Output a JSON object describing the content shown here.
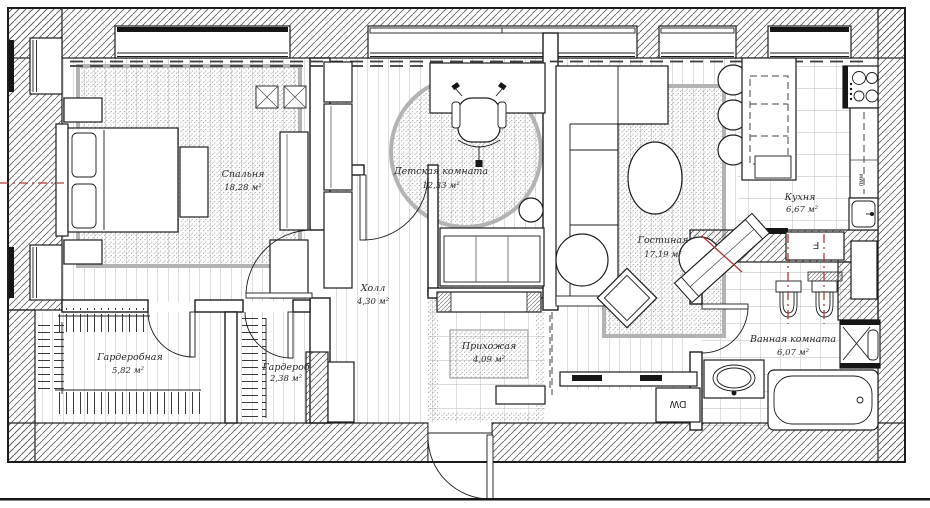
{
  "drawing": {
    "kind": "apartment-floor-plan",
    "rooms": [
      {
        "id": "bedroom",
        "name": "Спальня",
        "area": "18,28 м²"
      },
      {
        "id": "kids-room",
        "name": "Детская комната",
        "area": "12,33 м²"
      },
      {
        "id": "living-room",
        "name": "Гостиная",
        "area": "17,19 м²"
      },
      {
        "id": "kitchen",
        "name": "Кухня",
        "area": "6,67 м²"
      },
      {
        "id": "hall",
        "name": "Холл",
        "area": "4,30 м²"
      },
      {
        "id": "entry",
        "name": "Прихожая",
        "area": "4,09 м²"
      },
      {
        "id": "walk-in-closet",
        "name": "Гардеробная",
        "area": "5,82 м²"
      },
      {
        "id": "closet",
        "name": "Гардероб",
        "area": "2,38 м²"
      },
      {
        "id": "bathroom",
        "name": "Ванная комната",
        "area": "6,07 м²"
      }
    ],
    "appliance_labels": {
      "dishwasher_en": "DW",
      "dishwasher_ru": "пмм",
      "fridge": "F"
    },
    "colors": {
      "line": "#1c1c1c",
      "accent_red": "#b23a3a",
      "floor_line": "#b4b4b4",
      "rug_dot": "#9a9a9a"
    }
  }
}
